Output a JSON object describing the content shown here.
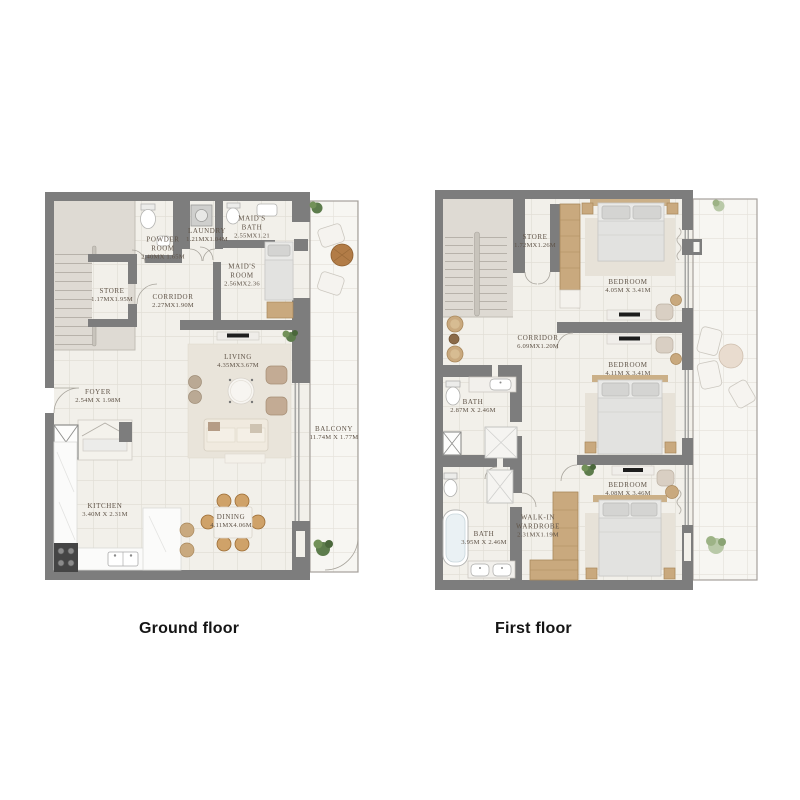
{
  "colors": {
    "wall": "#7d7d7d",
    "floor": "#f2f0ea",
    "balcony_floor": "#f7f6f2",
    "wood": "#c9a97e",
    "label_text": "#5f5347",
    "caption_text": "#151515"
  },
  "captions": [
    {
      "label": "Ground floor"
    },
    {
      "label": "First floor"
    }
  ],
  "floors": [
    {
      "name": "ground",
      "rooms": [
        {
          "name": "STORE",
          "dims": "1.17MX1.95M"
        },
        {
          "name": "POWDER ROOM",
          "dims": "2.40MX 1.65M"
        },
        {
          "name": "LAUNDRY",
          "dims": "1.21MX1.04M"
        },
        {
          "name": "MAID'S BATH",
          "dims": "2.55MX1.21"
        },
        {
          "name": "MAID'S ROOM",
          "dims": "2.56MX2.36"
        },
        {
          "name": "CORRIDOR",
          "dims": "2.27MX1.90M"
        },
        {
          "name": "LIVING",
          "dims": "4.35MX3.67M"
        },
        {
          "name": "FOYER",
          "dims": "2.54M X 1.98M"
        },
        {
          "name": "KITCHEN",
          "dims": "3.40M X 2.31M"
        },
        {
          "name": "DINING",
          "dims": "4.11MX4.06M"
        },
        {
          "name": "BALCONY",
          "dims": "11.74M X 1.77M"
        }
      ]
    },
    {
      "name": "first",
      "rooms": [
        {
          "name": "STORE",
          "dims": "1.72MX1.26M"
        },
        {
          "name": "BEDROOM",
          "dims": "4.05M X 3.41M"
        },
        {
          "name": "CORRIDOR",
          "dims": "6.09MX1.20M"
        },
        {
          "name": "BEDROOM",
          "dims": "4.11M X 3.41M"
        },
        {
          "name": "BATH",
          "dims": "2.87M X 2.46M"
        },
        {
          "name": "BEDROOM",
          "dims": "4.08M X 3.46M"
        },
        {
          "name": "BATH",
          "dims": "3.95M X 2.46M"
        },
        {
          "name": "WALK-IN WARDROBE",
          "dims": "2.31MX1.19M"
        }
      ]
    }
  ]
}
